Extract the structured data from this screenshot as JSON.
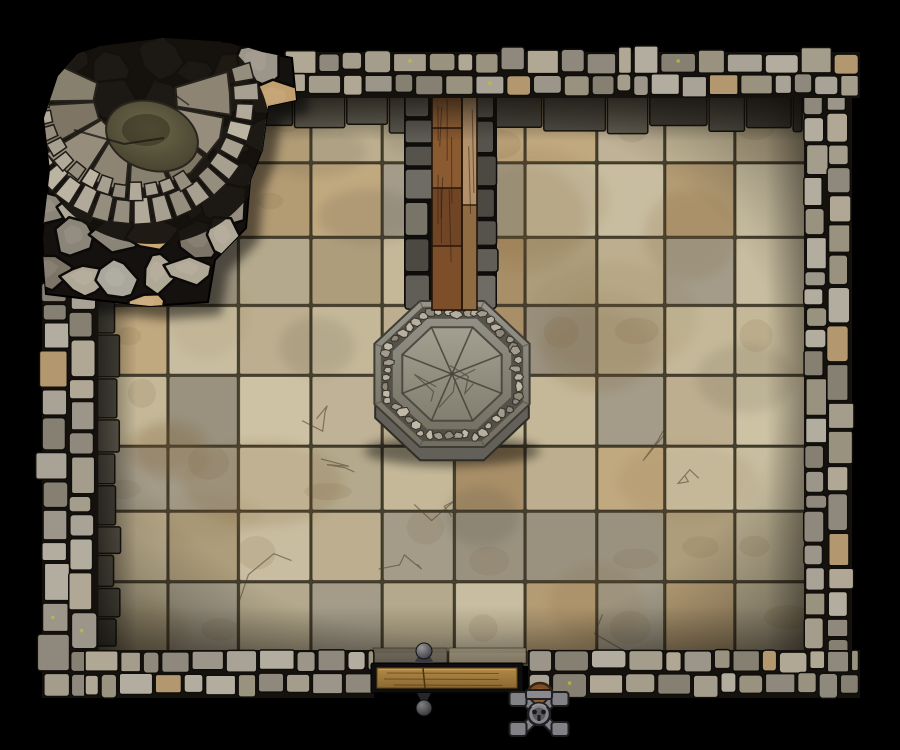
{
  "app": {
    "type": "virtual-tabletop-battle-map",
    "title": "Top-down stone dungeon chamber battle map",
    "visible_text": [],
    "background_color": "#000000"
  },
  "palette": {
    "background": "#000000",
    "floor_base_seam": "#46402f",
    "floor_tiles": [
      "#cdc2a4",
      "#c4b898",
      "#bcae8e",
      "#b4a98c",
      "#c0a87f",
      "#b39b74",
      "#a98f68",
      "#a49c89",
      "#9a927f",
      "#bfb296",
      "#c8bda0",
      "#ad9d7b"
    ],
    "floor_dark_edge": [
      "#5d5a50",
      "#524f46",
      "#676357",
      "#4a473f"
    ],
    "wall_stones": [
      "#a9a397",
      "#9c968a",
      "#8f897d",
      "#b3ada0",
      "#868073",
      "#98927f",
      "#a49d8b",
      "#b0a795"
    ],
    "wall_amber": "#b3986f",
    "wall_seam": "#15120e",
    "lichen": "#c8c133",
    "channel_stones": [
      "#6e6c64",
      "#605e56",
      "#55534b",
      "#787468",
      "#4b4942"
    ],
    "wood_planks_left": [
      "#96653a",
      "#8a5a30",
      "#6f4525",
      "#7d4e2a",
      "#5f3a20"
    ],
    "wood_planks_right": [
      "#b2906a",
      "#8f6b44"
    ],
    "wood_outline": "#241608",
    "platform_outer_top": "#97948a",
    "platform_outer_bottom": "#716e60",
    "platform_top": "#a39f91",
    "platform_bottom": "#827e70",
    "platform_ledge": "#63605a",
    "platform_seam": "#45423a",
    "rubble": [
      "#b6af9f",
      "#a39c8c",
      "#c0b9a8",
      "#8e887a"
    ],
    "rocks": [
      "#9c958a",
      "#8b8478",
      "#aaa79c",
      "#7b7467",
      "#b0a896",
      "#948d80"
    ],
    "rocks_amber": [
      "#c29f6f",
      "#caa878",
      "#a98a5d"
    ],
    "rock_seam": "#0b0a08",
    "stair_steps": [
      "#8d8474",
      "#968d7d",
      "#7e7565",
      "#87806f"
    ],
    "stair_bricks": [
      "#a79f8f",
      "#b1a999",
      "#958d7d",
      "#bcb4a3"
    ],
    "moss_center": "#6e6849",
    "moss_dark": "#3f3c2b",
    "bench_frame": "#0d0d10",
    "bench_wood_top": "#b28a47",
    "bench_wood_bottom": "#8a6832",
    "metal_light": "#97979b",
    "metal_dark": "#3f3f43",
    "vise_metal": "#828286",
    "vise_outline": "#1f1f22",
    "vise_wood": "#7a4c27"
  },
  "layout": {
    "canvas": {
      "width": 900,
      "height": 750
    },
    "floor": {
      "x": 97,
      "y": 95,
      "width": 709,
      "height": 558,
      "tile_cols": 10,
      "tile_rows": 8
    },
    "floor_patch": {
      "x": 372,
      "y": 648,
      "width": 156,
      "height": 16
    },
    "walls": [
      {
        "id": "wall-left",
        "x": 42,
        "y": 282,
        "width": 56,
        "height": 416,
        "vertical": true,
        "outer": "left"
      },
      {
        "id": "wall-right",
        "x": 804,
        "y": 52,
        "width": 48,
        "height": 646,
        "vertical": true,
        "outer": "right"
      },
      {
        "id": "wall-top",
        "x": 284,
        "y": 52,
        "width": 576,
        "height": 46,
        "vertical": false,
        "outer": "top"
      },
      {
        "id": "wall-bottom-left",
        "x": 84,
        "y": 650,
        "width": 290,
        "height": 48,
        "vertical": false,
        "outer": "bottom"
      },
      {
        "id": "wall-bottom-right",
        "x": 528,
        "y": 650,
        "width": 332,
        "height": 48,
        "vertical": false,
        "outer": "bottom"
      }
    ],
    "doorway": {
      "x": 374,
      "y": 650,
      "width": 154,
      "height": 48
    },
    "channel": {
      "x": 404,
      "y": 88,
      "width": 93,
      "height": 217
    },
    "walkway": {
      "left_board": {
        "x": 432,
        "y": 92,
        "width": 30,
        "height": 218
      },
      "right_board": {
        "x": 462,
        "y": 92,
        "width": 15,
        "height": 218
      },
      "seams_y": [
        128,
        188,
        246
      ],
      "right_seam_y": 205
    },
    "platform": {
      "cx": 452,
      "cy": 374,
      "rx": 84,
      "ry": 79,
      "rubble_scale": 0.84,
      "plate_scale": 0.64,
      "ledge_offset": 14
    },
    "outcrop": {
      "points": [
        [
          100,
          46
        ],
        [
          165,
          38
        ],
        [
          230,
          42
        ],
        [
          262,
          52
        ],
        [
          292,
          58
        ],
        [
          296,
          100
        ],
        [
          268,
          106
        ],
        [
          262,
          150
        ],
        [
          250,
          180
        ],
        [
          246,
          228
        ],
        [
          215,
          260
        ],
        [
          208,
          302
        ],
        [
          150,
          306
        ],
        [
          96,
          300
        ],
        [
          46,
          294
        ],
        [
          42,
          238
        ],
        [
          50,
          170
        ],
        [
          44,
          118
        ],
        [
          58,
          76
        ],
        [
          78,
          54
        ]
      ],
      "stairs": {
        "cx": 134,
        "cy": 100,
        "sweep_start": -18,
        "sweep_end": 206,
        "wedge_count": 8,
        "inner_r": 42,
        "outer_r": 96,
        "brick_r0": 100,
        "brick_r1": 122,
        "brick2_r0": 84,
        "brick2_r1": 100,
        "brick2_start": 55,
        "moss": {
          "cx": 152,
          "cy": 136,
          "rx": 47,
          "ry": 34,
          "rot": 18
        }
      }
    },
    "bench": {
      "frame": {
        "x": 371,
        "y": 663,
        "width": 152,
        "height": 30
      },
      "wood": {
        "x": 377,
        "y": 668,
        "width": 140,
        "height": 20
      },
      "seam_x": 423,
      "finial_top": {
        "cx": 424,
        "cy": 651,
        "r": 8
      },
      "finial_bottom": {
        "cx": 424,
        "cy": 708,
        "r": 8
      }
    },
    "vise": {
      "cx": 539,
      "cy": 714,
      "wood_cap": {
        "cx": 1,
        "cy": -18,
        "r": 13
      }
    }
  },
  "objects": [
    {
      "id": "room",
      "name": "stone chamber with flagstone floor and cobble walls",
      "interactable": false
    },
    {
      "id": "spiral-staircase",
      "name": "curved stone staircase in rocky alcove (top-left)",
      "interactable": true
    },
    {
      "id": "wooden-walkway",
      "name": "wooden plank walkway from north wall down to platform",
      "interactable": true
    },
    {
      "id": "octagonal-platform",
      "name": "raised octagonal stone platform",
      "interactable": true
    },
    {
      "id": "wooden-bench",
      "name": "wooden bench bar across south doorway with ball finials",
      "interactable": true
    },
    {
      "id": "anvil-vise",
      "name": "iron vise / tool mount just outside south doorway",
      "interactable": true
    }
  ]
}
